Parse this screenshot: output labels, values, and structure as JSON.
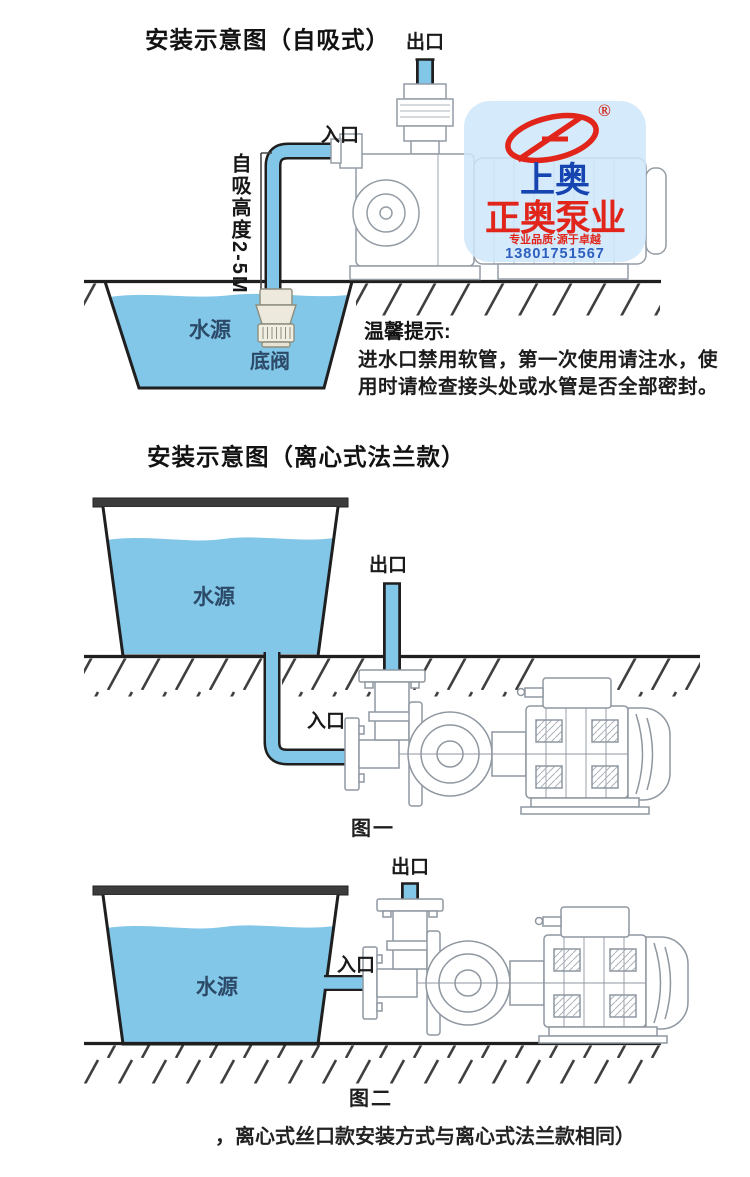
{
  "colors": {
    "water_blue": "#82C6E8",
    "outline_dark": "#1f1f1f",
    "line_art_gray": "#8f97a0",
    "brand_red": "#E1251B",
    "brand_blue": "#1644B0",
    "phone_blue": "#2E5FC0",
    "badge_bg": "rgba(206,230,250,0.86)"
  },
  "diagram1": {
    "title": "安装示意图（自吸式）",
    "outlet_label": "出口",
    "inlet_label": "入口",
    "suction_height_label": "自吸高度2-5M",
    "water_source_label": "水源",
    "foot_valve_label": "底阀",
    "tips_heading": "温馨提示:",
    "tips_line1": "进水口禁用软管，第一次使用请注水，使",
    "tips_line2": "用时请检查接头处或水管是否全部密封。"
  },
  "logo_badge": {
    "registered_mark": "®",
    "brand_top": "上奥",
    "brand_main": "正奥泵业",
    "slogan": "专业品质·源于卓越",
    "phone": "13801751567"
  },
  "diagram2": {
    "title": "安装示意图（离心式法兰款）",
    "outlet_label": "出口",
    "inlet_label": "入口",
    "water_source_label": "水源",
    "caption": "图一"
  },
  "diagram3": {
    "outlet_label": "出口",
    "inlet_label": "入口",
    "water_source_label": "水源",
    "caption": "图二",
    "note": "，离心式丝口款安装方式与离心式法兰款相同）"
  }
}
